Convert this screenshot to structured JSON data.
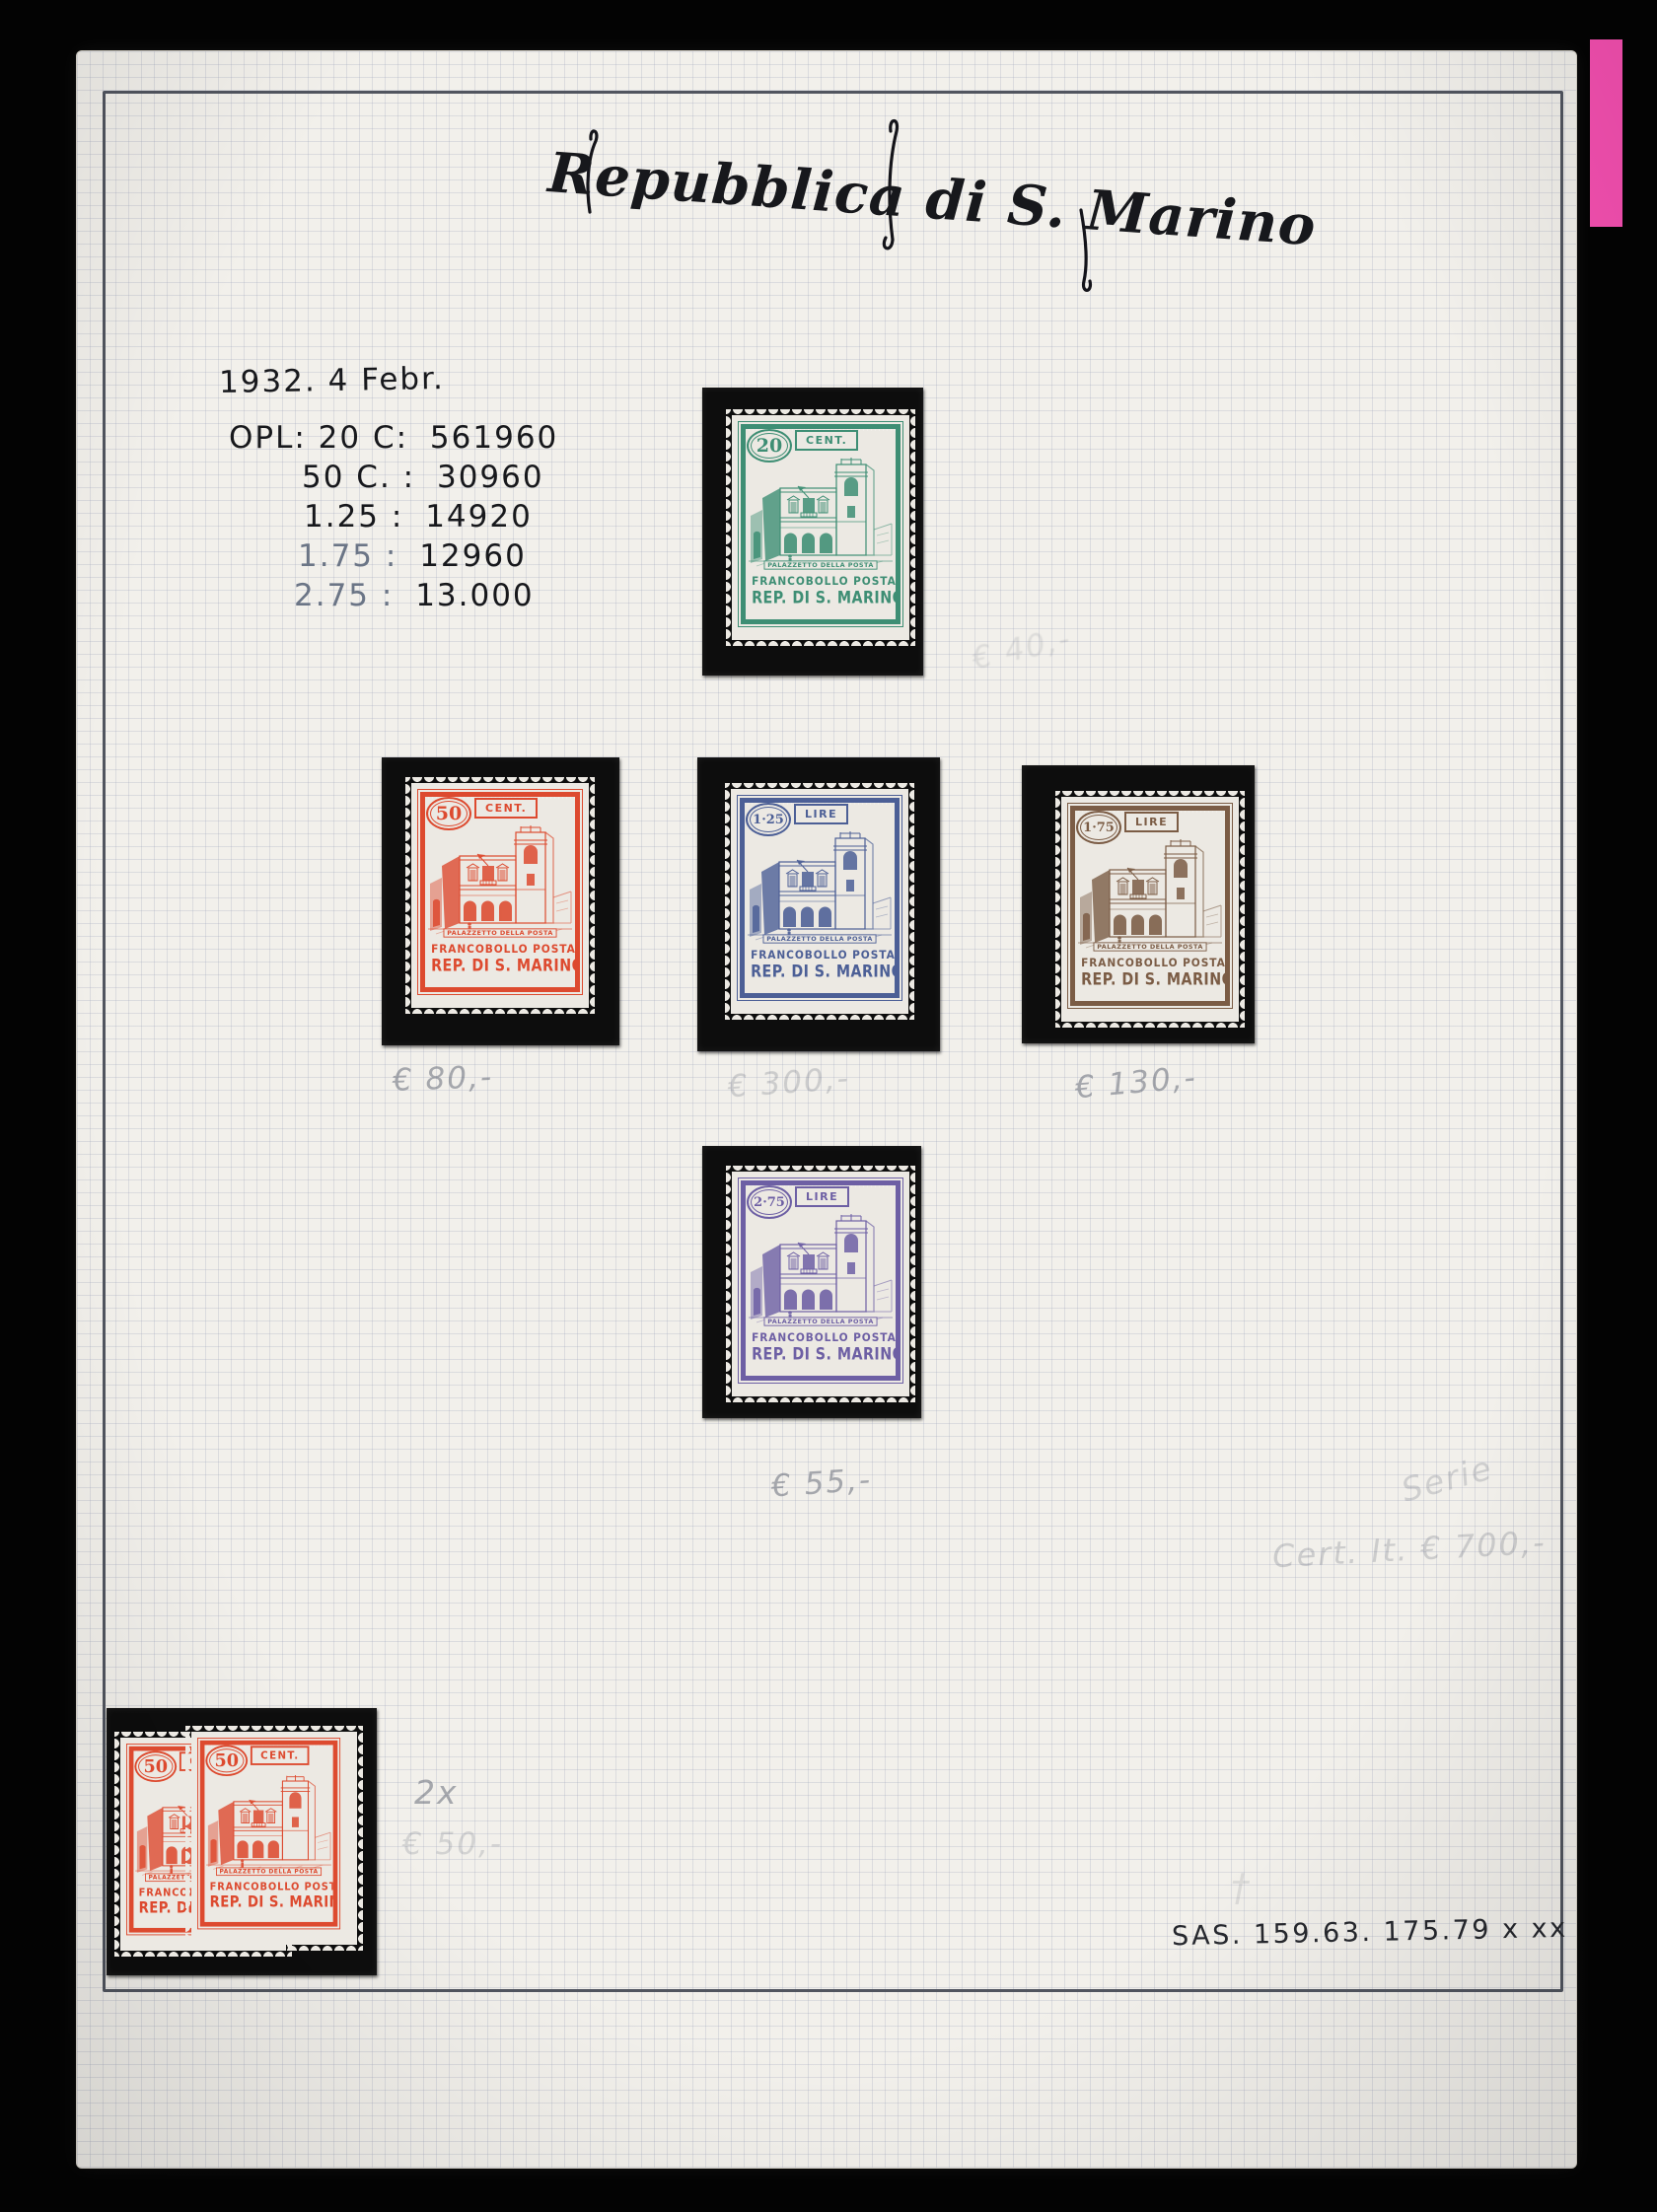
{
  "photo": {
    "tab_color": "#f750b2"
  },
  "title": "Repubblica di S. Marino",
  "notes": {
    "date": "1932. 4 Febr.",
    "opl_label": "OPL:",
    "print_runs": [
      {
        "denom": "20 C:",
        "qty": "561960"
      },
      {
        "denom": "50 C. :",
        "qty": "30960"
      },
      {
        "denom": "1.25 :",
        "qty": "14920"
      },
      {
        "denom": "1.75 :",
        "qty": "12960"
      },
      {
        "denom": "2.75 :",
        "qty": "13.000"
      }
    ],
    "pencil": {
      "price_20c": "€ 40,-",
      "price_50c": "€ 80,-",
      "price_125": "€ 300,-",
      "price_175": "€ 130,-",
      "price_275": "€ 55,-",
      "serie": "Serie",
      "certificate": "Cert. It. € 700,-",
      "pair_count": "2x",
      "pair_price": "€ 50,-",
      "erased_mark": "†"
    },
    "catalog": "SAS. 159.63.  175.79 x xx"
  },
  "stamp_common": {
    "caption": "PALAZZETTO DELLA POSTA",
    "line1": "FRANCOBOLLO POSTALE",
    "line2": "REP. DI S. MARINO"
  },
  "stamps": [
    {
      "value": "20",
      "unit": "CENT.",
      "color": "#3e8e74"
    },
    {
      "value": "50",
      "unit": "CENT.",
      "color": "#dd4a2f"
    },
    {
      "value": "1·25",
      "unit": "LIRE",
      "color": "#4c5f96"
    },
    {
      "value": "1·75",
      "unit": "LIRE",
      "color": "#7b5c45"
    },
    {
      "value": "2·75",
      "unit": "LIRE",
      "color": "#6d5fa4"
    }
  ]
}
